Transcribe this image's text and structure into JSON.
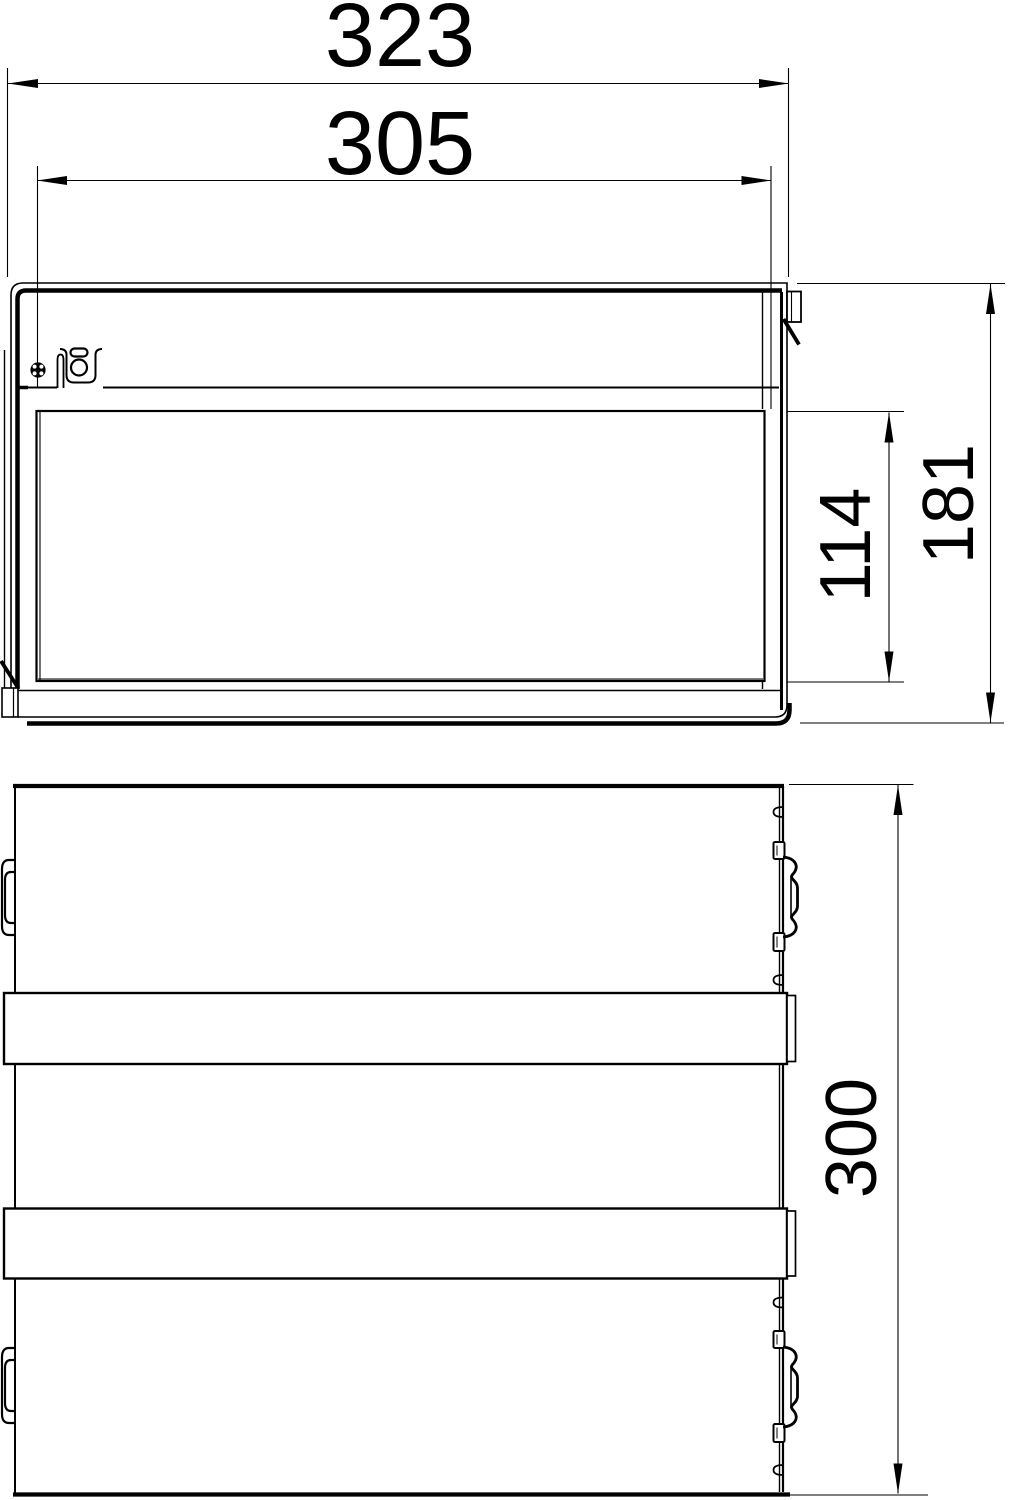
{
  "page": {
    "background_color": "#ffffff",
    "line_color": "#000000",
    "kind": "technical dimensional drawing, two orthographic views of a cable trunking / junction box"
  },
  "drawing": {
    "views": [
      {
        "id": "front-view",
        "description": "front elevation with lid, screw, cable bracket, side latch"
      },
      {
        "id": "top-view",
        "description": "plan view with two mounting rails and side spring clips"
      }
    ],
    "dimensions": {
      "overall_width": {
        "value": "323",
        "orientation": "horizontal",
        "view": "front-view"
      },
      "inner_width": {
        "value": "305",
        "orientation": "horizontal",
        "view": "front-view"
      },
      "inner_height": {
        "value": "114",
        "orientation": "vertical",
        "view": "front-view"
      },
      "overall_height": {
        "value": "181",
        "orientation": "vertical",
        "view": "front-view"
      },
      "depth": {
        "value": "300",
        "orientation": "vertical",
        "view": "top-view"
      }
    }
  }
}
